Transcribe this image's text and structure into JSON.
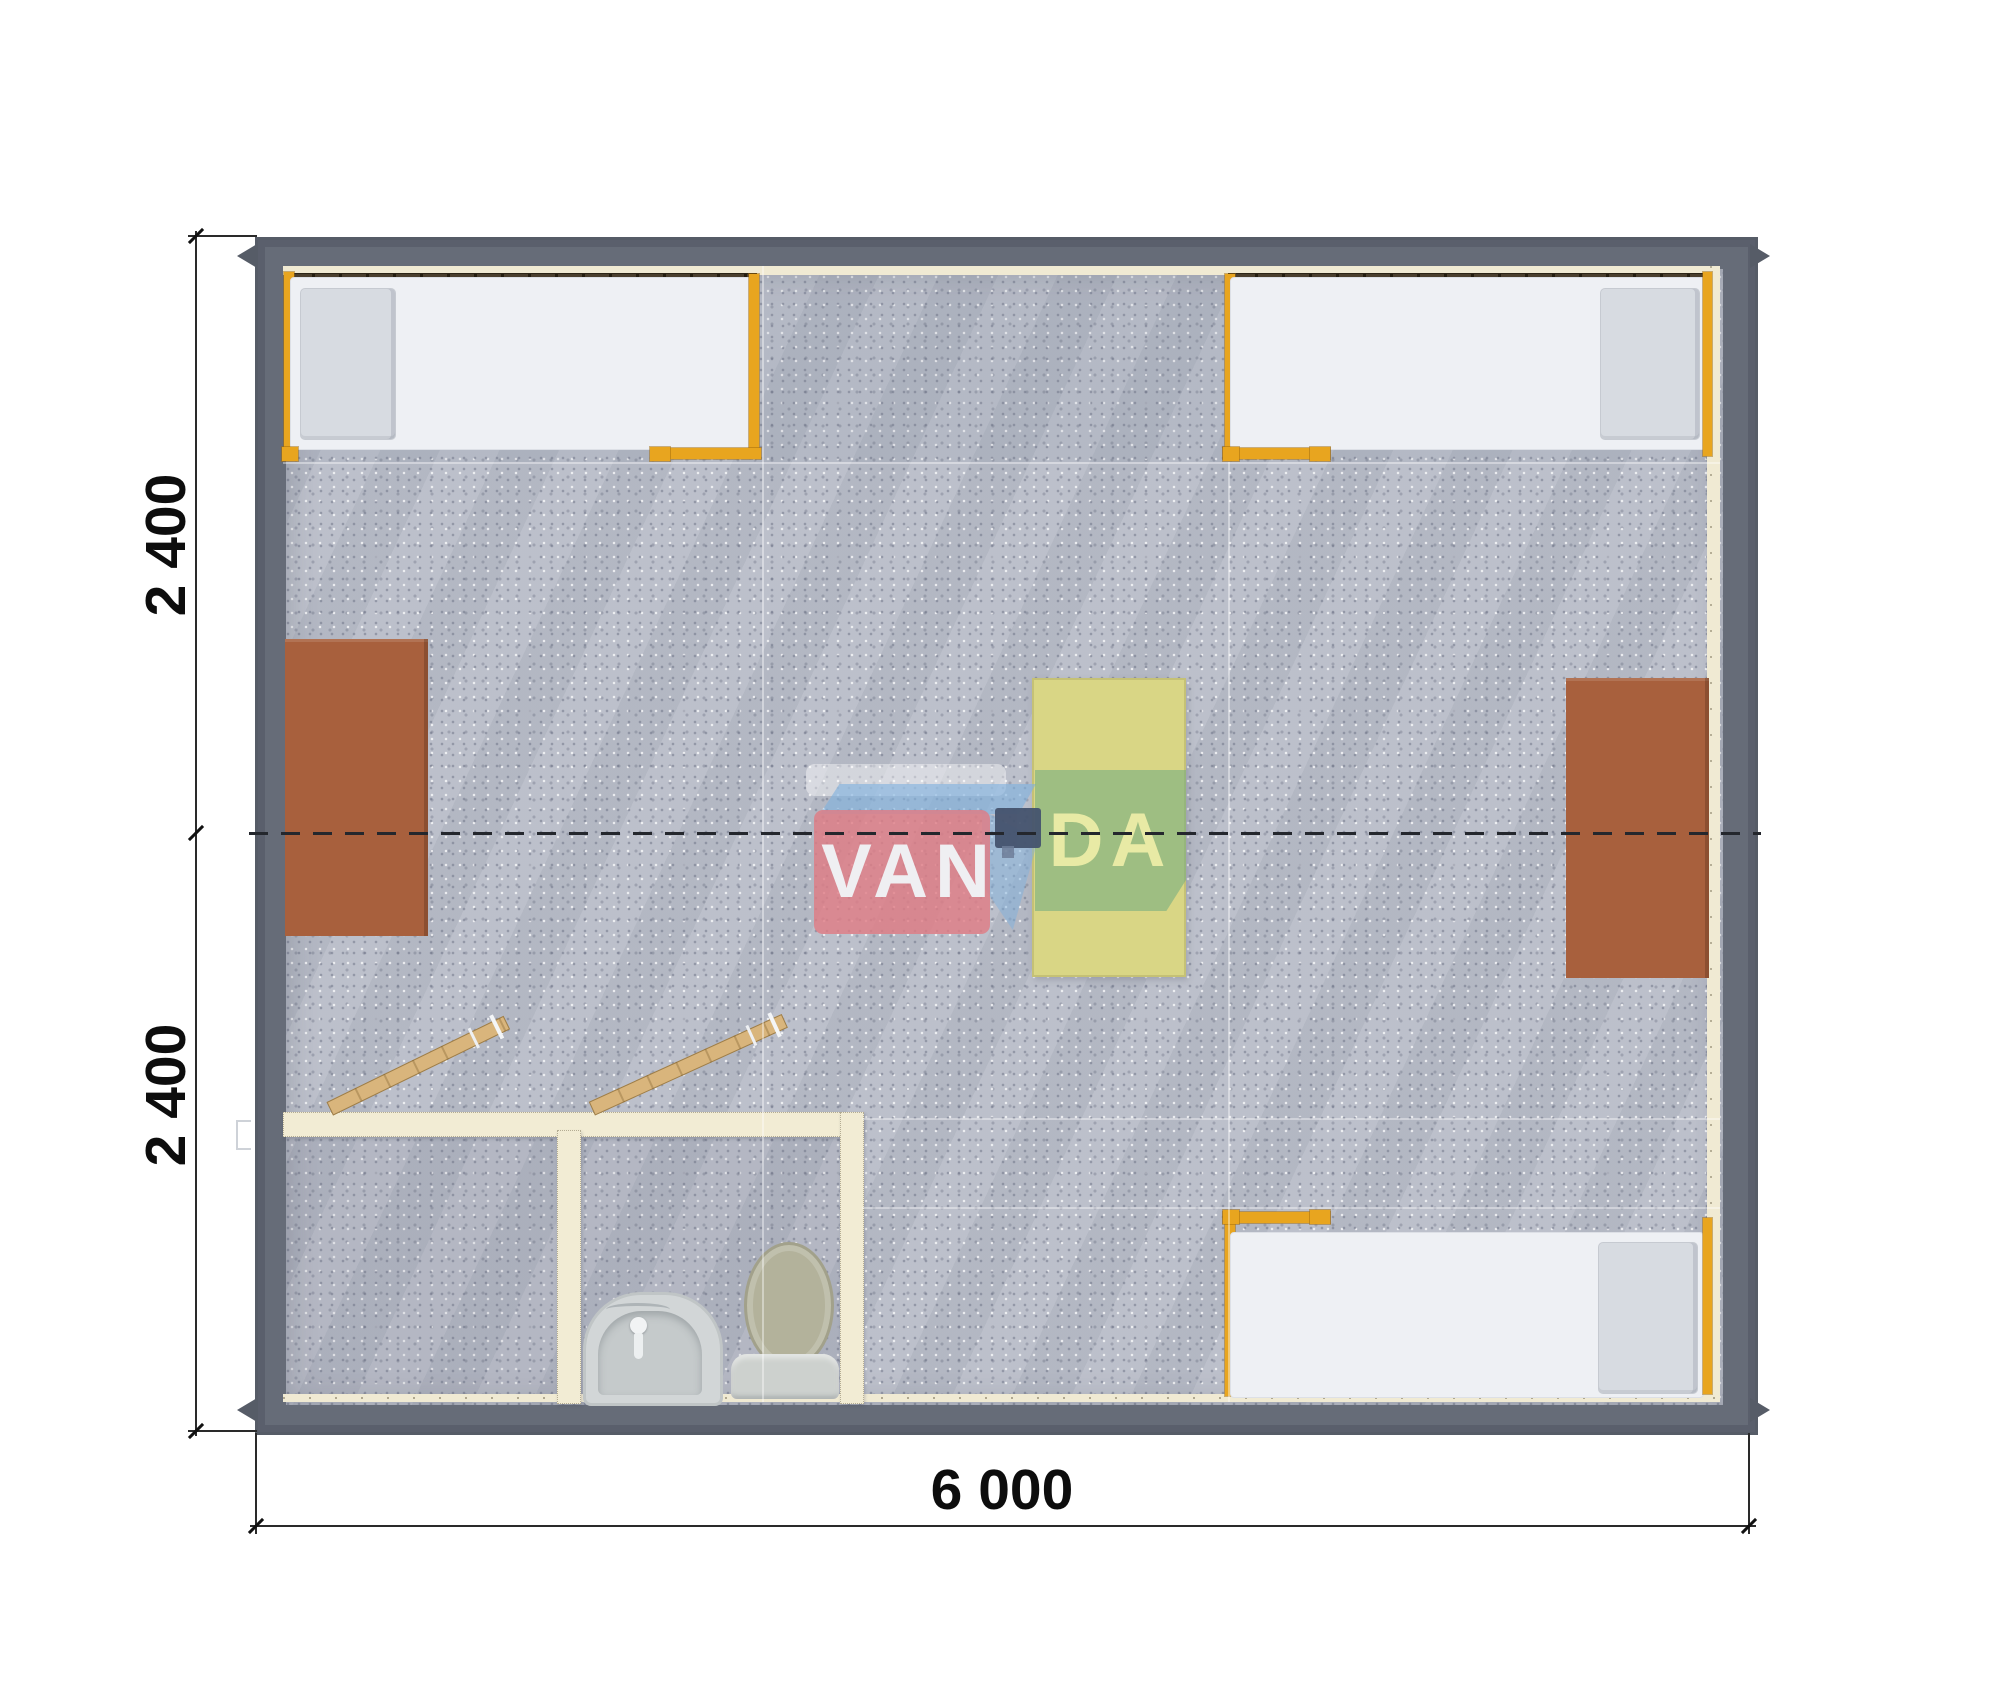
{
  "drawing": {
    "type": "modular-building-floor-plan",
    "watermark": {
      "part1": "VAN",
      "part2": "DA"
    },
    "dimensions": {
      "left_top": "2 400",
      "left_bottom": "2 400",
      "bottom": "6 000"
    },
    "colors": {
      "wall": "#666c78",
      "wall_rim": "#565c67",
      "floor": "#b9bdc8",
      "lining": "#f0ead3",
      "window_band": "#4a3f2e",
      "bed_frame": "#e8a51f",
      "mattress": "#eef0f4",
      "pillow": "#d7dbe1",
      "desk": "#a8603d",
      "table": "#d9d685",
      "partition": "#f2ecd4",
      "door": "#d9b57c",
      "toilet_lid": "#b3b29b",
      "fixture": "#d2d6d7",
      "logo_pink": "rgba(223,125,133,0.82)",
      "logo_green": "rgba(118,174,128,0.60)",
      "logo_blue": "rgba(128,178,222,0.62)",
      "logo_navy": "#45536e",
      "dim": "#2a2a2a"
    }
  }
}
